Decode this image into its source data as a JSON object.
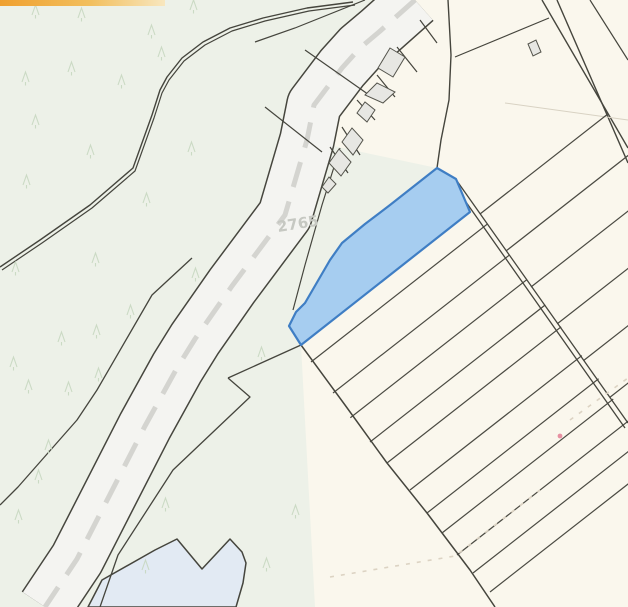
{
  "map": {
    "width": 628,
    "height": 607,
    "parcel_label": {
      "text": "2765",
      "x": 278,
      "y": 232,
      "rotation": -9
    },
    "selected_parcel_color": "#a6cdf0",
    "selected_parcel_border": "#3f7ec4",
    "colors": {
      "cream": "#faf7ed",
      "green": "#edf1e8",
      "road_fill": "#f4f4f1",
      "road_dash": "#d4d4d0",
      "line": "#45453d",
      "building_fill": "#e7e7e3",
      "building_stroke": "#54544c",
      "pond": "#e2eaf3",
      "tree": "#c7d7c0",
      "faint_dash": "#dcd3c3",
      "faint_line": "#d8d2c3",
      "label_gray": "#c6c8c2",
      "pink_dot": "#e791a2",
      "accent0": "#efa02f",
      "accent1": "#f2bf5e",
      "accent2": "#f8e7bf"
    },
    "tree_glyph": "M0 0 L3.5 -10 L7 0 M3.5 0 L3.5 3.5",
    "trees": [
      [
        32,
        15
      ],
      [
        78,
        18
      ],
      [
        148,
        35
      ],
      [
        190,
        10
      ],
      [
        22,
        82
      ],
      [
        68,
        72
      ],
      [
        118,
        85
      ],
      [
        158,
        57
      ],
      [
        32,
        125
      ],
      [
        87,
        155
      ],
      [
        188,
        152
      ],
      [
        23,
        185
      ],
      [
        143,
        203
      ],
      [
        12,
        272
      ],
      [
        92,
        263
      ],
      [
        192,
        278
      ],
      [
        127,
        315
      ],
      [
        93,
        335
      ],
      [
        58,
        342
      ],
      [
        10,
        367
      ],
      [
        25,
        390
      ],
      [
        95,
        378
      ],
      [
        65,
        392
      ],
      [
        45,
        450
      ],
      [
        35,
        480
      ],
      [
        15,
        520
      ],
      [
        258,
        357
      ],
      [
        292,
        515
      ],
      [
        162,
        508
      ],
      [
        142,
        570
      ],
      [
        263,
        568
      ]
    ],
    "features": [
      {
        "name": "map-background",
        "type": "rect",
        "x": 0,
        "y": 0,
        "width": 628,
        "height": 607,
        "fill": "#faf7ed"
      },
      {
        "name": "forest-area-west",
        "type": "polygon",
        "points": "0,0 415,0 379,32 360,48 342,68 314,105 307,140 285,215 232,286 195,339 177,368 145,426 77,559 45,607 0,607",
        "fill": "#edf1e8"
      },
      {
        "name": "green-strip-east-of-road",
        "type": "polygon",
        "points": "307,140 352,150 437,168 390,205 365,224 342,243 330,260 305,303 296,312 289,326 301,345 305,420 315,607 45,607 77,559 145,426 177,368 195,339 232,286 285,215",
        "fill": "#edf1e8"
      },
      {
        "name": "pond-parcel",
        "type": "polygon",
        "points": "102,580 155,550 177,539 202,569 230,539 242,552 246,563 243,583 236,607 88,607",
        "fill": "#e2eaf3",
        "stroke": "#45453d",
        "w": 1.5,
        "join": "round"
      },
      {
        "name": "road-casing",
        "type": "polyline",
        "points": "415,0 379,32 360,48 342,68 314,105 307,140 285,215 232,286 195,339 177,368 145,426 77,559 45,607",
        "stroke": "#46463e",
        "w": 56,
        "join": "round",
        "cap": "butt"
      },
      {
        "name": "road-surface",
        "type": "polyline",
        "points": "415,0 379,32 360,48 342,68 314,105 307,140 285,215 232,286 195,339 177,368 145,426 77,559 45,607",
        "stroke": "#f4f4f1",
        "w": 53,
        "join": "round",
        "cap": "butt"
      },
      {
        "name": "road-centerline-dashes",
        "type": "polyline",
        "points": "415,0 379,32 360,48 342,68 314,105 307,140 285,215 232,286 195,339 177,368 145,426 77,559 45,607",
        "stroke": "#d4d4d0",
        "w": 5,
        "dash": "26 15",
        "join": "round",
        "cap": "butt"
      },
      {
        "name": "forest-boundary-outer",
        "type": "polyline",
        "points": "353,2 307,8 263,18 230,28 203,42 182,58 167,77 160,90 152,115 133,168 90,205 40,240 0,267",
        "stroke": "#45453d",
        "w": 1.4,
        "join": "round"
      },
      {
        "name": "forest-boundary-inner",
        "type": "polyline",
        "points": "355,5 309,11 265,21 232,31 205,45 184,61 169,80 162,93 154,118 135,171 92,208 42,243 2,270",
        "stroke": "#45453d",
        "w": 1.2,
        "join": "round"
      },
      {
        "name": "parcel-line-west-parallel",
        "type": "polyline",
        "points": "192,258 152,295 97,390 77,420 18,487 0,505",
        "stroke": "#45453d",
        "w": 1.3,
        "join": "round"
      },
      {
        "name": "parcel-line-top-sliver",
        "type": "polyline",
        "points": "365,0 295,28 255,42",
        "stroke": "#45453d",
        "w": 1.2
      },
      {
        "name": "parcel-line-band-1",
        "type": "line",
        "x1": 305,
        "y1": 50,
        "x2": 372,
        "y2": 97,
        "stroke": "#45453d",
        "w": 1.2
      },
      {
        "name": "parcel-line-band-2",
        "type": "line",
        "x1": 265,
        "y1": 107,
        "x2": 322,
        "y2": 152,
        "stroke": "#45453d",
        "w": 1.2
      },
      {
        "name": "parcel-line-mid-sliver",
        "type": "polyline",
        "points": "340,148 322,205 305,265 293,310",
        "stroke": "#45453d",
        "w": 1.2
      },
      {
        "name": "parcel-line-junction",
        "type": "line",
        "x1": 301,
        "y1": 345,
        "x2": 228,
        "y2": 378,
        "stroke": "#45453d",
        "w": 1.3
      },
      {
        "name": "parcel-line-roadside-sliver",
        "type": "polyline",
        "points": "228,378 250,397 173,470 118,555 100,607",
        "stroke": "#45453d",
        "w": 1.3,
        "join": "round"
      },
      {
        "name": "building-band-boundary",
        "type": "polyline",
        "points": "448,0 451,55 449,100 441,140 437,168",
        "stroke": "#45453d",
        "w": 1.4,
        "join": "round"
      },
      {
        "name": "building-parcel-tick-1",
        "type": "line",
        "x1": 420,
        "y1": 20,
        "x2": 437,
        "y2": 43,
        "stroke": "#45453d",
        "w": 1.2
      },
      {
        "name": "building-parcel-tick-2",
        "type": "line",
        "x1": 397,
        "y1": 47,
        "x2": 417,
        "y2": 72,
        "stroke": "#45453d",
        "w": 1.2
      },
      {
        "name": "building-parcel-tick-3",
        "type": "line",
        "x1": 377,
        "y1": 75,
        "x2": 395,
        "y2": 97,
        "stroke": "#45453d",
        "w": 1.2
      },
      {
        "name": "building-parcel-tick-4",
        "type": "line",
        "x1": 357,
        "y1": 100,
        "x2": 375,
        "y2": 120,
        "stroke": "#45453d",
        "w": 1.2
      },
      {
        "name": "building-parcel-tick-5",
        "type": "line",
        "x1": 342,
        "y1": 127,
        "x2": 360,
        "y2": 155,
        "stroke": "#45453d",
        "w": 1.2
      },
      {
        "name": "building-parcel-tick-6",
        "type": "line",
        "x1": 330,
        "y1": 147,
        "x2": 348,
        "y2": 173,
        "stroke": "#45453d",
        "w": 1.2
      },
      {
        "name": "northeast-road-edge-1",
        "type": "line",
        "x1": 542,
        "y1": 0,
        "x2": 628,
        "y2": 148,
        "stroke": "#45453d",
        "w": 1.4
      },
      {
        "name": "northeast-road-edge-2",
        "type": "line",
        "x1": 557,
        "y1": 0,
        "x2": 628,
        "y2": 163,
        "stroke": "#45453d",
        "w": 1.4
      },
      {
        "name": "northeast-corner-line",
        "type": "line",
        "x1": 590,
        "y1": 0,
        "x2": 628,
        "y2": 60,
        "stroke": "#45453d",
        "w": 1.2
      },
      {
        "name": "northeast-connector-line",
        "type": "line",
        "x1": 549,
        "y1": 18,
        "x2": 455,
        "y2": 57,
        "stroke": "#45453d",
        "w": 1.2
      },
      {
        "name": "faint-parcel-line",
        "type": "line",
        "x1": 505,
        "y1": 103,
        "x2": 628,
        "y2": 120,
        "stroke": "#d8d2c3",
        "w": 1
      },
      {
        "name": "strip-origin-diagonal",
        "type": "polyline",
        "points": "301,345 345,405 387,463 427,513 470,570 495,607",
        "stroke": "#45453d",
        "w": 1.5,
        "join": "round"
      },
      {
        "name": "strip-line",
        "type": "line",
        "x1": 311,
        "y1": 362,
        "x2": 784,
        "y2": -8,
        "stroke": "#4a4a42",
        "w": 1.2,
        "clip": "clipB"
      },
      {
        "name": "strip-line",
        "type": "line",
        "x1": 333,
        "y1": 393,
        "x2": 806,
        "y2": 23,
        "stroke": "#4a4a42",
        "w": 1.2,
        "clip": "clipB"
      },
      {
        "name": "strip-line",
        "type": "line",
        "x1": 350,
        "y1": 418,
        "x2": 823,
        "y2": 48,
        "stroke": "#4a4a42",
        "w": 1.2,
        "clip": "clipB"
      },
      {
        "name": "strip-line",
        "type": "line",
        "x1": 370,
        "y1": 442,
        "x2": 843,
        "y2": 72,
        "stroke": "#4a4a42",
        "w": 1.2,
        "clip": "clipB"
      },
      {
        "name": "strip-line",
        "type": "line",
        "x1": 387,
        "y1": 463,
        "x2": 860,
        "y2": 93,
        "stroke": "#4a4a42",
        "w": 1.2,
        "clip": "clipB"
      },
      {
        "name": "strip-line",
        "type": "line",
        "x1": 410,
        "y1": 490,
        "x2": 883,
        "y2": 120,
        "stroke": "#4a4a42",
        "w": 1.2,
        "clip": "clipB"
      },
      {
        "name": "strip-line",
        "type": "line",
        "x1": 427,
        "y1": 513,
        "x2": 900,
        "y2": 143,
        "stroke": "#4a4a42",
        "w": 1.2,
        "clip": "clipB"
      },
      {
        "name": "strip-line",
        "type": "line",
        "x1": 442,
        "y1": 533,
        "x2": 915,
        "y2": 163,
        "stroke": "#4a4a42",
        "w": 1.2,
        "clip": "clipB"
      },
      {
        "name": "strip-line",
        "type": "line",
        "x1": 457,
        "y1": 555,
        "x2": 930,
        "y2": 185,
        "stroke": "#4a4a42",
        "w": 1.2,
        "clip": "clipB"
      },
      {
        "name": "strip-line",
        "type": "line",
        "x1": 473,
        "y1": 573,
        "x2": 946,
        "y2": 203,
        "stroke": "#4a4a42",
        "w": 1.2,
        "clip": "clipB"
      },
      {
        "name": "strip-line",
        "type": "line",
        "x1": 490,
        "y1": 592,
        "x2": 963,
        "y2": 222,
        "stroke": "#4a4a42",
        "w": 1.2,
        "clip": "clipB"
      },
      {
        "name": "strip-line",
        "type": "line",
        "x1": 480,
        "y1": 214,
        "x2": 953,
        "y2": -156,
        "stroke": "#4a4a42",
        "w": 1.2,
        "clip": "clipA"
      },
      {
        "name": "strip-line",
        "type": "line",
        "x1": 506,
        "y1": 251,
        "x2": 979,
        "y2": -119,
        "stroke": "#4a4a42",
        "w": 1.2,
        "clip": "clipA"
      },
      {
        "name": "strip-line",
        "type": "line",
        "x1": 531,
        "y1": 287,
        "x2": 1004,
        "y2": -83,
        "stroke": "#4a4a42",
        "w": 1.2,
        "clip": "clipA"
      },
      {
        "name": "strip-line",
        "type": "line",
        "x1": 557,
        "y1": 324,
        "x2": 1030,
        "y2": -46,
        "stroke": "#4a4a42",
        "w": 1.2,
        "clip": "clipA"
      },
      {
        "name": "strip-line",
        "type": "line",
        "x1": 583,
        "y1": 361,
        "x2": 1056,
        "y2": -9,
        "stroke": "#4a4a42",
        "w": 1.2,
        "clip": "clipA"
      },
      {
        "name": "strip-line",
        "type": "line",
        "x1": 609,
        "y1": 398,
        "x2": 1082,
        "y2": 28,
        "stroke": "#4a4a42",
        "w": 1.2,
        "clip": "clipA"
      },
      {
        "name": "field-path-edge-1",
        "type": "line",
        "x1": 457,
        "y1": 181,
        "x2": 628,
        "y2": 423,
        "stroke": "#45453d",
        "w": 1.3
      },
      {
        "name": "field-path-edge-2",
        "type": "line",
        "x1": 454,
        "y1": 185,
        "x2": 625,
        "y2": 428,
        "stroke": "#45453d",
        "w": 1.3
      },
      {
        "name": "building",
        "type": "polygon",
        "points": "378,68 390,48 405,57 393,77",
        "fill": "#e7e7e3",
        "stroke": "#54544c",
        "w": 1
      },
      {
        "name": "building",
        "type": "polygon",
        "points": "365,95 377,83 395,92 383,103",
        "fill": "#e7e7e3",
        "stroke": "#54544c",
        "w": 1
      },
      {
        "name": "building",
        "type": "polygon",
        "points": "357,113 365,102 375,110 367,122",
        "fill": "#e7e7e3",
        "stroke": "#54544c",
        "w": 1
      },
      {
        "name": "building",
        "type": "polygon",
        "points": "342,142 352,128 363,140 353,155",
        "fill": "#e7e7e3",
        "stroke": "#54544c",
        "w": 1
      },
      {
        "name": "building",
        "type": "polygon",
        "points": "329,163 339,149 351,162 341,176",
        "fill": "#e7e7e3",
        "stroke": "#54544c",
        "w": 1
      },
      {
        "name": "building",
        "type": "polygon",
        "points": "322,187 329,177 336,184 328,193",
        "fill": "#e7e7e3",
        "stroke": "#54544c",
        "w": 1
      },
      {
        "name": "building",
        "type": "polygon",
        "points": "528,44 536,40 541,52 533,56",
        "fill": "#e7e7e3",
        "stroke": "#54544c",
        "w": 1
      },
      {
        "name": "selected-parcel",
        "type": "polygon",
        "points": "437,168 456,179 470,212 301,345 289,326 296,312 305,303 330,260 342,243 365,224 390,205",
        "fill": "#a6cdf0",
        "stroke": "#3f7ec4",
        "w": 2.2,
        "join": "round",
        "interactable": true
      },
      {
        "name": "tree-symbols",
        "type": "trees"
      },
      {
        "name": "faint-track-dashes-1",
        "type": "polyline",
        "points": "330,577 455,556 540,490",
        "stroke": "#dcd3c3",
        "w": 1.6,
        "dash": "4 7"
      },
      {
        "name": "faint-track-dashes-2",
        "type": "line",
        "x1": 570,
        "y1": 420,
        "x2": 628,
        "y2": 378,
        "stroke": "#dcd3c3",
        "w": 1.6,
        "dash": "4 7"
      },
      {
        "name": "parcel-number-label",
        "type": "text",
        "x": 278,
        "y": 232,
        "text": "2765",
        "fill": "#c6c8c2",
        "fontSize": 15,
        "weight": "bold",
        "transform": "rotate(-9 278 232)"
      },
      {
        "name": "pink-marker-dot",
        "type": "circle",
        "cx": 560,
        "cy": 436,
        "r": 2.4,
        "fill": "#e791a2"
      },
      {
        "name": "top-accent-bar",
        "type": "rect",
        "x": 0,
        "y": 0,
        "width": 165,
        "height": 6,
        "fill": "url(#accgrad)"
      }
    ]
  }
}
